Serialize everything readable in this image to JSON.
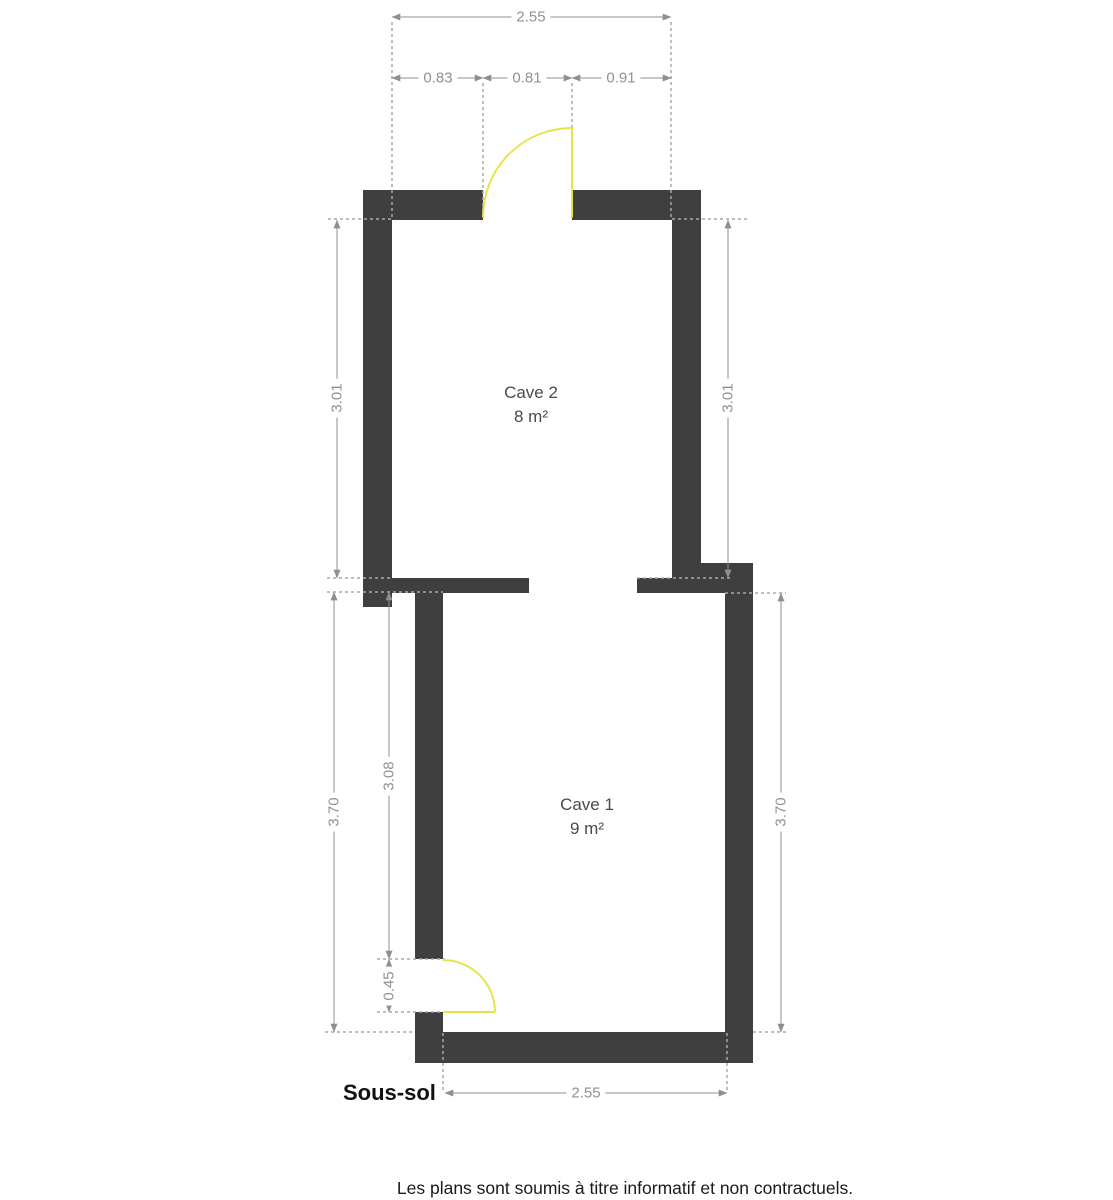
{
  "plan": {
    "floor_label": "Sous-sol",
    "footer_note": "Les plans sont soumis à titre informatif et non contractuels.",
    "rooms": {
      "cave2": {
        "name": "Cave 2",
        "area": "8 m²"
      },
      "cave1": {
        "name": "Cave 1",
        "area": "9 m²"
      }
    },
    "dimensions": {
      "top_total": "2.55",
      "top_left_segment": "0.83",
      "top_door_width": "0.81",
      "top_right_segment": "0.91",
      "cave2_height_left": "3.01",
      "cave2_height_right": "3.01",
      "cave1_height_left": "3.70",
      "cave1_inner_height": "3.08",
      "cave1_door_height": "0.45",
      "cave1_height_right": "3.70",
      "bottom_total": "2.55"
    },
    "colors": {
      "wall": "#3f3f3f",
      "dimension": "#8f8f8f",
      "door": "#e9e34b"
    }
  }
}
